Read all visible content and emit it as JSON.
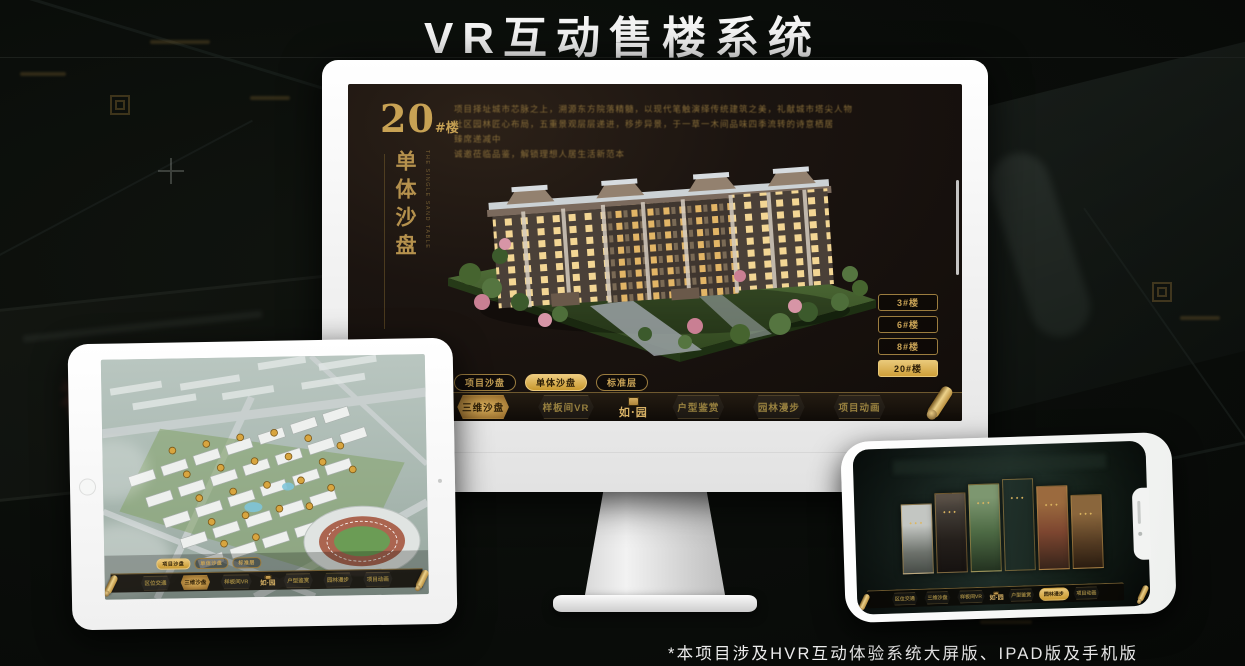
{
  "title": "VR互动售楼系统",
  "footnote": "*本项目涉及HVR互动体验系统大屏版、IPAD版及手机版",
  "brand": {
    "logo_text": "如·园",
    "gold": "#c9a356",
    "active_gold": "#d8ac52"
  },
  "nav": {
    "items": [
      {
        "label": "区位交通"
      },
      {
        "label": "三维沙盘"
      },
      {
        "label": "样板间VR"
      },
      {
        "label": "户型鉴赏"
      },
      {
        "label": "园林漫步"
      },
      {
        "label": "项目动画"
      }
    ]
  },
  "tabs": [
    {
      "label": "项目沙盘"
    },
    {
      "label": "单体沙盘"
    },
    {
      "label": "标准层"
    }
  ],
  "monitor": {
    "building_no": "20",
    "building_no_suffix": "#楼",
    "section_title": "单体沙盘",
    "section_title_en": "THE SINGLE SAND TABLE",
    "description_lines": [
      "项目择址城市芯脉之上，溯源东方院落精髓，以现代笔触演绎传统建筑之美，礼献城市塔尖人物",
      "社区园林匠心布局，五重景观层层递进，移步异景，于一草一木间品味四季流转的诗意栖居",
      "臻席递减中",
      "诚邀莅临品鉴，解锁理想人居生活新范本"
    ],
    "floor_buttons": [
      {
        "label": "3#楼"
      },
      {
        "label": "6#楼"
      },
      {
        "label": "8#楼"
      },
      {
        "label": "20#楼"
      }
    ],
    "active_floor": "20#楼",
    "active_tab": "单体沙盘",
    "active_nav": "三维沙盘"
  },
  "tablet": {
    "active_tab": "项目沙盘",
    "active_nav": "三维沙盘"
  },
  "phone": {
    "active_nav": "园林漫步",
    "panels": [
      "courtyard",
      "dark-interior",
      "garden",
      "building-facade",
      "autumn-trees",
      "warm-interior"
    ]
  },
  "background": {
    "sign_text": "福星惠誉"
  },
  "icons": {
    "nav_end": "golden-scroll-icon",
    "logo_seal": "seal-stamp-icon",
    "tablet_home": "home-button",
    "phone_speaker": "speaker-slit",
    "phone_camera": "camera-dot"
  }
}
